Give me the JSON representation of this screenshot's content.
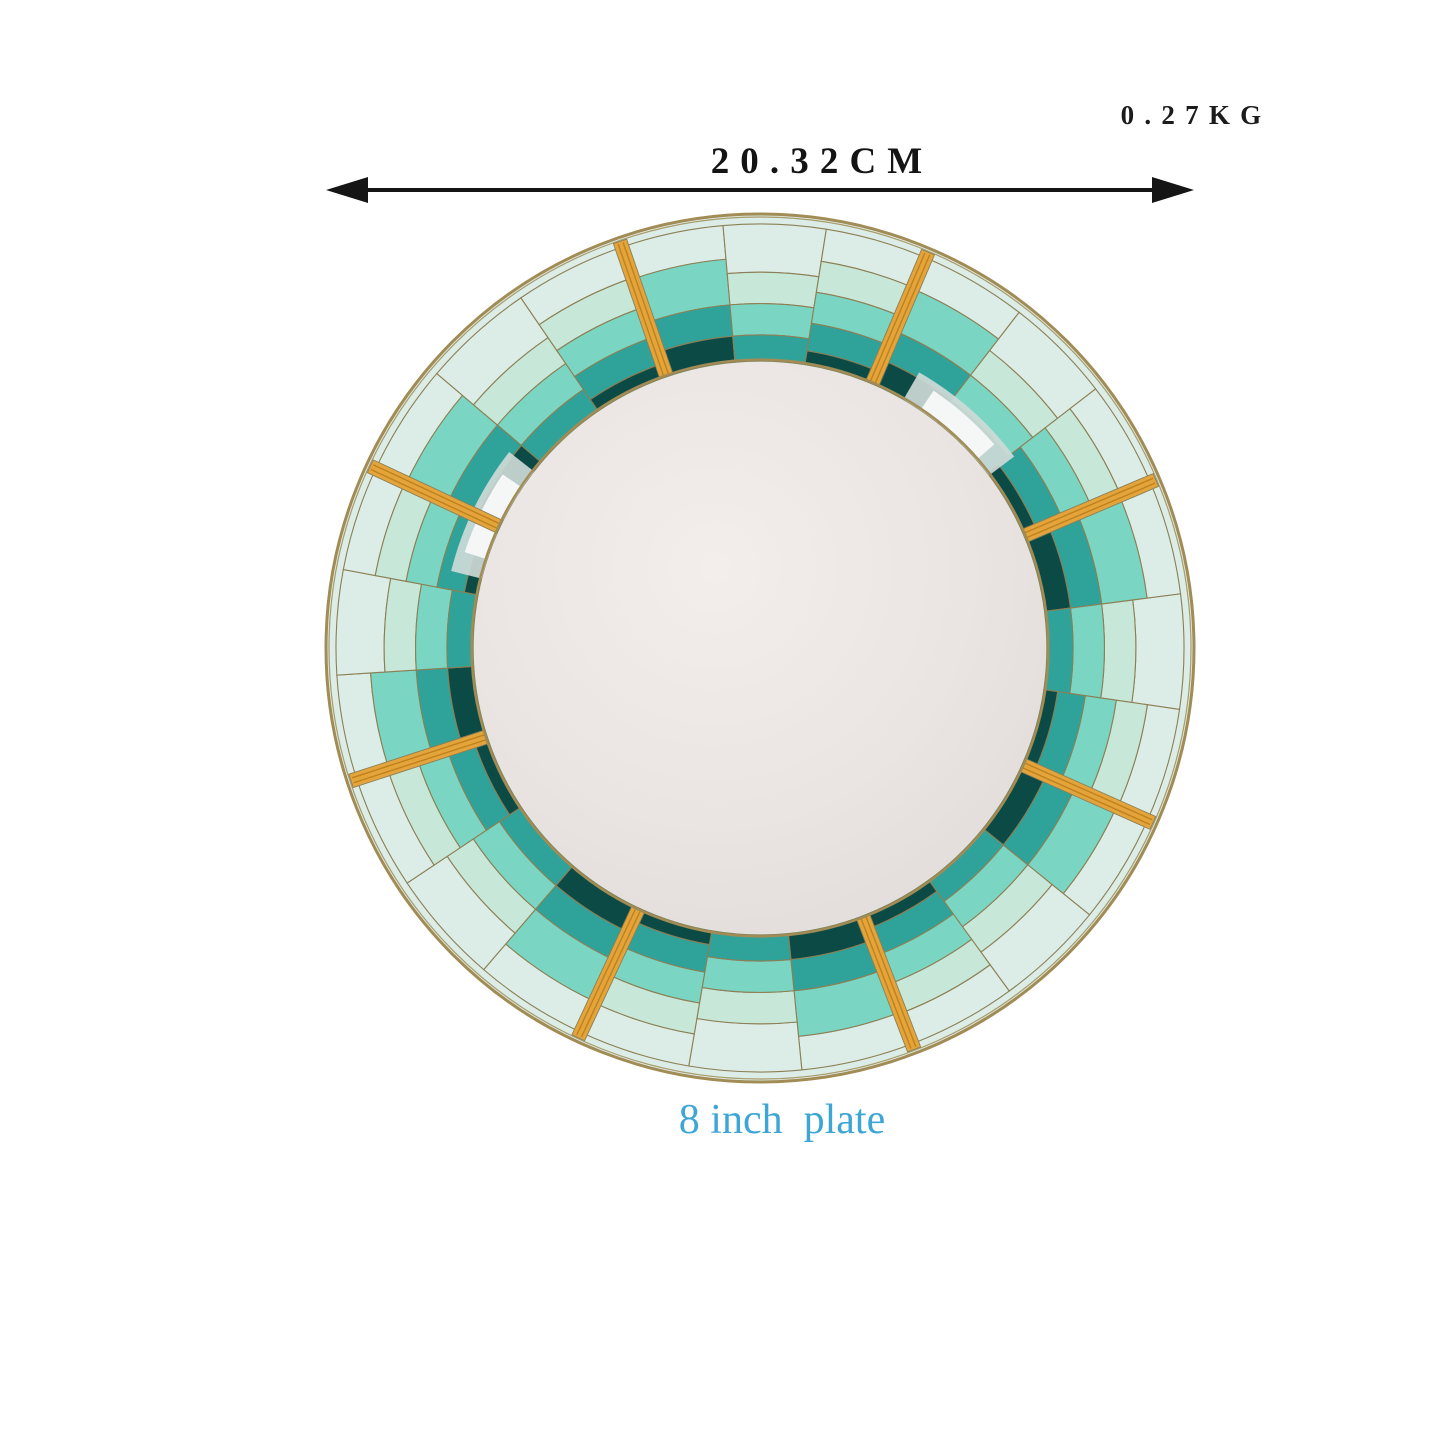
{
  "annotations": {
    "weight": "0.27KG",
    "diameter": "20.32CM",
    "caption": "8 inch  plate"
  },
  "caption_color": "#3ea6d7",
  "annotation_color": "#151515",
  "plate": {
    "radius": 436,
    "inner_ring_frac": 0.658,
    "outer_hairline_frac": 0.9725,
    "spoke_angles_deg": [
      23,
      67,
      114,
      159,
      205,
      252,
      295,
      341
    ],
    "slice_templates": [
      [
        [
          "pale",
          0.895,
          0.9725
        ],
        [
          "aqua",
          0.79,
          0.895
        ],
        [
          "teal",
          0.718,
          0.79
        ],
        [
          "dark",
          0.658,
          0.718
        ]
      ],
      [
        [
          "pale",
          0.862,
          0.9725
        ],
        [
          "mint",
          0.79,
          0.862
        ],
        [
          "aqua",
          0.718,
          0.79
        ],
        [
          "teal",
          0.658,
          0.718
        ]
      ],
      [
        [
          "pale",
          0.898,
          0.9725
        ],
        [
          "mint",
          0.826,
          0.898
        ],
        [
          "aqua",
          0.754,
          0.826
        ],
        [
          "teal",
          0.69,
          0.754
        ],
        [
          "dark",
          0.658,
          0.69
        ]
      ]
    ],
    "sheen_arcs_deg": [
      [
        30,
        53
      ],
      [
        284,
        308
      ]
    ],
    "palette": {
      "pale": "#DCEDE7",
      "mint": "#C7E7D8",
      "aqua": "#7AD6C2",
      "teal": "#2FA39A",
      "dark": "#0C4B45",
      "gold": "#E4A43C",
      "gold_stripe": "#BC7E18",
      "hairline": "#8B7F55",
      "rim_gold": "#A18C55",
      "sheen_outer": "#CFDCD8",
      "sheen_inner": "#F4F7F6",
      "center_light": "#F3EEEC",
      "center_mid": "#EAE4E2",
      "center_edge": "#DFD9D7"
    }
  }
}
